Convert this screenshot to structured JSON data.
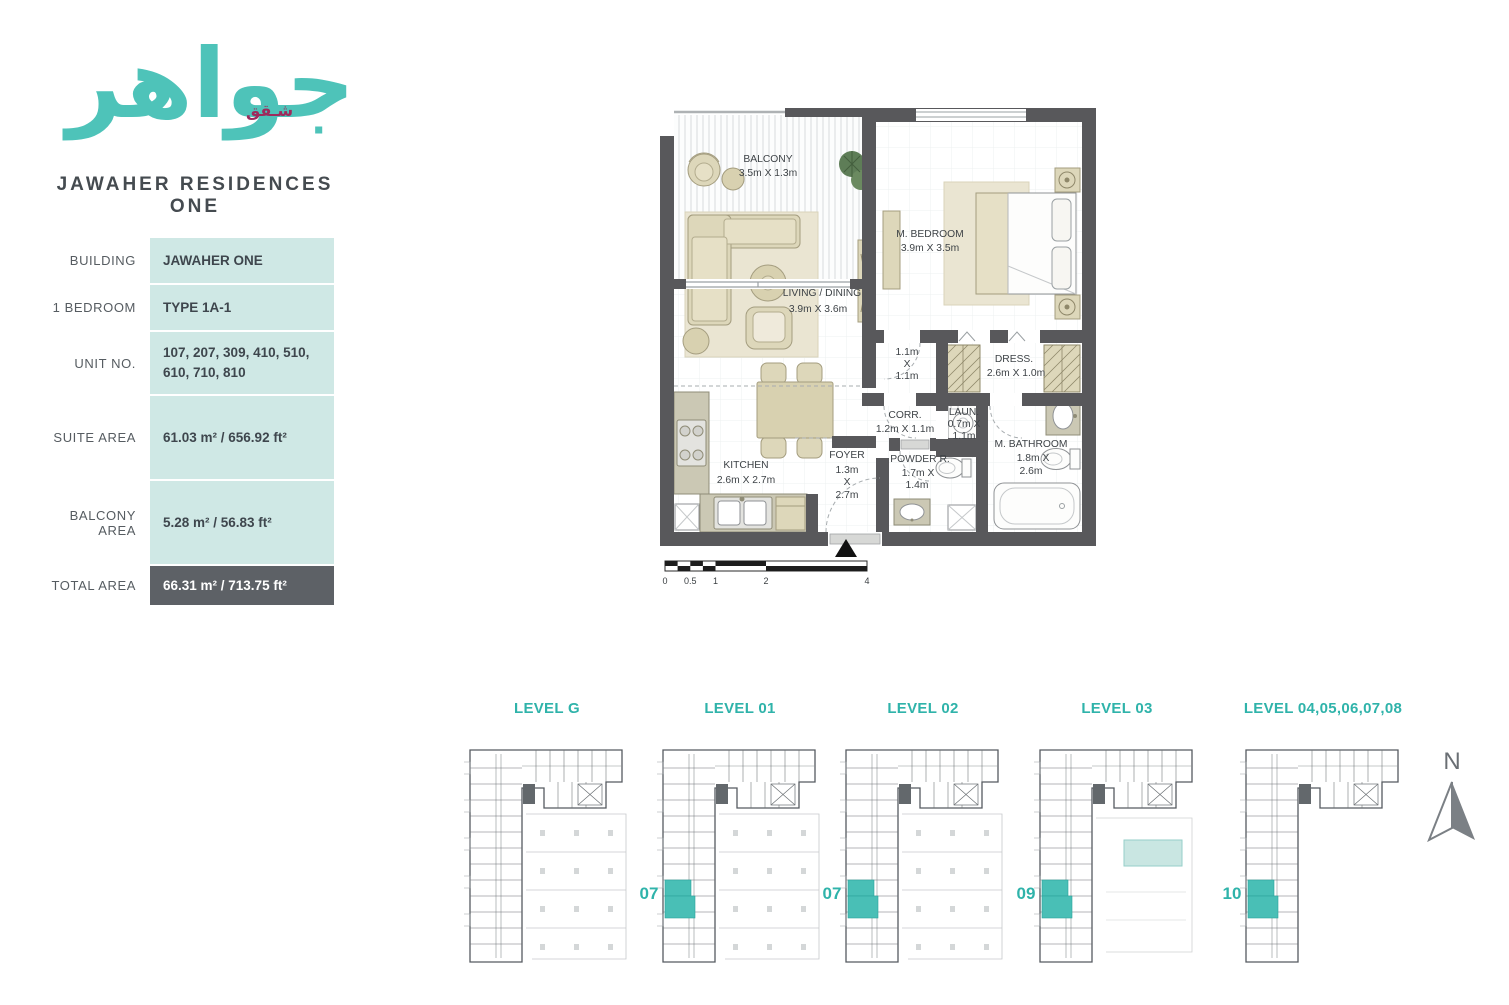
{
  "logo": {
    "arabic": "جواهر",
    "arabic_sub": "شـقق",
    "brand": "JAWAHER RESIDENCES ONE"
  },
  "colors": {
    "teal_accent": "#3db5ac",
    "maroon_accent": "#9e2b5c",
    "cell_bg": "#cfe8e5",
    "total_row_bg": "#5d6166",
    "wall_gray": "#58585b",
    "unit_highlight": "#49bfb6",
    "furniture_beige": "#ddd7ba"
  },
  "info_table": {
    "rows": [
      {
        "label": "BUILDING",
        "value": "JAWAHER ONE"
      },
      {
        "label": "1 BEDROOM",
        "value": "TYPE 1A-1"
      },
      {
        "label": "UNIT NO.",
        "value": "107, 207, 309, 410, 510, 610, 710, 810"
      },
      {
        "label": "SUITE AREA",
        "value": "61.03 m² / 656.92 ft²"
      },
      {
        "label": "BALCONY AREA",
        "value": "5.28 m² / 56.83 ft²"
      },
      {
        "label": "TOTAL AREA",
        "value": "66.31 m² / 713.75 ft²"
      }
    ]
  },
  "plan": {
    "balcony": {
      "name": "BALCONY",
      "dims": "3.5m X 1.3m"
    },
    "bedroom": {
      "name": "M. BEDROOM",
      "dims": "3.9m X 3.5m"
    },
    "living": {
      "name": "LIVING / DINING",
      "dims": "3.9m X 3.6m"
    },
    "closet": {
      "l1": "1.1m",
      "l2": "X",
      "l3": "1.1m"
    },
    "dress": {
      "name": "DRESS.",
      "dims": "2.6m X 1.0m"
    },
    "corr": {
      "name": "CORR.",
      "dims": "1.2m X 1.1m"
    },
    "laun": {
      "name": "LAUN.",
      "l1": "0.7m X",
      "l2": "1.1m"
    },
    "bath": {
      "name": "M. BATHROOM",
      "l1": "1.8m X",
      "l2": "2.6m"
    },
    "kitchen": {
      "name": "KITCHEN",
      "dims": "2.6m X 2.7m"
    },
    "foyer": {
      "name": "FOYER",
      "l1": "1.3m",
      "l2": "X",
      "l3": "2.7m"
    },
    "powder": {
      "name": "POWDER R.",
      "l1": "1.7m X",
      "l2": "1.4m"
    },
    "scale": {
      "t0": "0",
      "t1": "0.5",
      "t2": "1",
      "t3": "2",
      "t4": "4"
    }
  },
  "levels": [
    {
      "label": "LEVEL G",
      "unit": ""
    },
    {
      "label": "LEVEL 01",
      "unit": "07"
    },
    {
      "label": "LEVEL 02",
      "unit": "07"
    },
    {
      "label": "LEVEL 03",
      "unit": "09"
    },
    {
      "label": "LEVEL 04,05,06,07,08",
      "unit": "10"
    }
  ],
  "compass": {
    "label": "N"
  }
}
